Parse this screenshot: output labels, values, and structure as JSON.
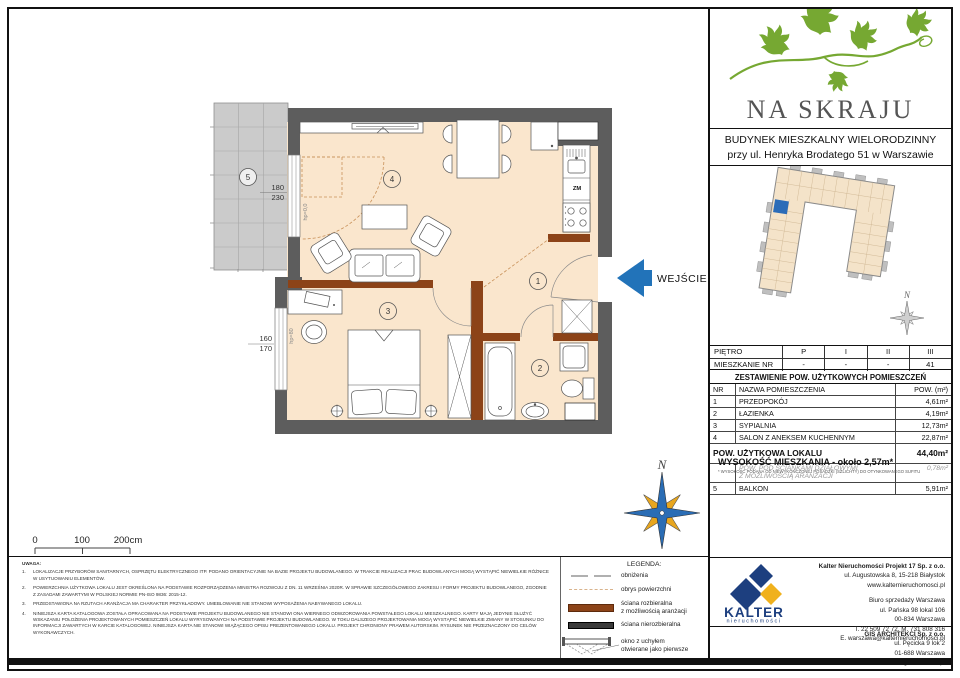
{
  "plan": {
    "entrance": "WEJŚCIE",
    "rooms": {
      "r1": "1",
      "r2": "2",
      "r3": "3",
      "r4": "4",
      "r5": "5"
    },
    "dims": {
      "balcony_w": "180",
      "balcony_h": "230",
      "window_w": "160",
      "window_h": "170"
    },
    "labels": {
      "hp_door": "hp=0,0",
      "hp_window": "hp=80",
      "dishwasher": "ZM"
    },
    "scale": {
      "t0": "0",
      "t1": "100",
      "t2": "200cm"
    },
    "north": "N"
  },
  "brand": {
    "name": "NA SKRAJU",
    "building1": "BUDYNEK MIESZKALNY WIELORODZINNY",
    "building2": "przy ul. Henryka Brodatego 51 w Warszawie",
    "north": "N"
  },
  "floor_table": {
    "row1_label": "PIĘTRO",
    "row1": [
      "P",
      "I",
      "II",
      "III"
    ],
    "row2_label": "MIESZKANIE NR",
    "row2": [
      "-",
      "-",
      "-",
      "41"
    ]
  },
  "area_table": {
    "title": "ZESTAWIENIE POW. UŻYTKOWYCH POMIESZCZEŃ",
    "headers": [
      "NR",
      "NAZWA POMIESZCZENIA",
      "POW. (m²)"
    ],
    "rows": [
      [
        "1",
        "PRZEDPOKÓJ",
        "4,61m²"
      ],
      [
        "2",
        "ŁAZIENKA",
        "4,19m²"
      ],
      [
        "3",
        "SYPIALNIA",
        "12,73m²"
      ],
      [
        "4",
        "SALON Z ANEKSEM KUCHENNYM",
        "22,87m²"
      ]
    ],
    "total_label": "POW. UŻYTKOWA LOKALU",
    "total_value": "44,40m²",
    "partition_label": "POW. POD ŚCIANKAMI DZIAŁOWYMI\nZ MOŻLIWOŚCIĄ ARANŻACJI",
    "partition_value": "0,78m²",
    "balcony_row": [
      "5",
      "BALKON",
      "5,91m²"
    ],
    "height_label": "WYSOKOŚĆ MIESZKANIA - około 2,57m*",
    "height_note": "* WYSOKOŚĆ PODANA OD NIEWYKOŃCZONEJ POSADZKI (SZLICHTY) DO OTYNKOWANEGO SUFITU"
  },
  "legend": {
    "title": "LEGENDA:",
    "lowering": "obniżenia",
    "outline": "obrys powierzchni",
    "removable": "ściana rozbieralna\nz możliwością aranżacji",
    "fixed": "ściana nierozbieralna",
    "window": "okno z uchyłem\notwierane jako pierwsze"
  },
  "notes": {
    "title": "UWAGA:",
    "items": [
      {
        "n": "1.",
        "text": "LOKALIZACJE PRZYBORÓW SANITARNYCH, OSPRZĘTU ELEKTRYCZNEGO ITP. PODANO ORIENTACYJNIE NA BAZIE PROJEKTU BUDOWLANEGO. W TRAKCIE REALIZACJI PRAC BUDOWLANYCH MOGĄ WYSTĄPIĆ NIEWIELKIE RÓŻNICE W USYTUOWANIU ELEMENTÓW."
      },
      {
        "n": "2.",
        "text": "POWIERZCHNIA UŻYTKOWA LOKALU JEST OKREŚLONA NA PODSTAWIE ROZPORZĄDZENIA MINISTRA ROZWOJU Z DN. 11 WRZEŚNIA 2020R. W SPRAWIE SZCZEGÓŁOWEGO ZAKRESU I FORMY PROJEKTU BUDOWLANEGO, ZGODNIE Z ZASADAMI ZAWARTYMI W POLSKIEJ NORMIE PN-ISO 9836: 2015-12."
      },
      {
        "n": "3.",
        "text": "PRZEDSTAWIONA NA RZUTACH ARANŻACJA MA CHARAKTER PRZYKŁADOWY. UMEBLOWANIE NIE STANOWI WYPOSAŻENIA NABYWANEGO LOKALU."
      },
      {
        "n": "4.",
        "text": "NINIEJSZA KARTA KATALOGOWA ZOSTAŁA OPRACOWANA NA PODSTAWIE PROJEKTU BUDOWLANEGO NIE STANOWI ONA WIERNEGO ODWZOROWANIA POWSTAŁEGO LOKALU MIESZKALNEGO. KARTY MAJĄ JEDYNIE SŁUŻYĆ WSKAZANIU POŁOŻENIA PROJEKTOWANYCH POMIESZCZEŃ LOKALU WYRYSOWANYCH NA PODSTAWIE PROJEKTU BUDOWLANEGO. W TOKU DALSZEGO PROJEKTOWANIA MOGĄ WYSTĄPIĆ NIEWIELKIE ZMIANY W STOSUNKU DO INFORMACJI ZAWARTYCH W KARCIE KATALOGOWEJ. NINIEJSZA KARTA NIE STANOWI WIĄŻĄCEGO OPISU PREZENTOWANEGO LOKALU. PROJEKT CHRONIONY PRAWEM AUTORSKIM. RYSUNEK NIE PRZEZNACZONY DO CELÓW WYKONAWCZYCH."
      }
    ]
  },
  "companies": {
    "kalter": {
      "brand": "KALTER",
      "brand_sub": "nieruchomości",
      "name": "Kalter Nieruchomości Projekt 17 Sp. z o.o.",
      "addr1": "ul. Augustowska 8, 15-218 Białystok",
      "addr2": "www.kalternieruchomosci.pl",
      "office1": "Biuro sprzedaży Warszawa",
      "office2": "ul. Pańska 98 lokal 106",
      "office3": "00-834 Warszawa",
      "office4": "T. 22 509 72 72. M. 731 808 316",
      "office5": "E. warszawa@kalternieruchomosci.pl"
    },
    "gis": {
      "name": "GIS ARCHITEKCI Sp. z o.o.",
      "line1": "ul. Pęcicka 9 lok 2",
      "line2": "01-688 Warszawa",
      "line3": "www.gisarchitekci.pl"
    }
  },
  "colors": {
    "removable_wall": "#8c4318",
    "exterior_wall": "#5d5d5d",
    "floor": "#fae6cd",
    "entrance_arrow": "#2273b9",
    "logo_green": "#76a832",
    "kalter_navy": "#1d3f7f",
    "kalter_yellow": "#f0b11d",
    "unit_highlight": "#2b6cb8"
  }
}
